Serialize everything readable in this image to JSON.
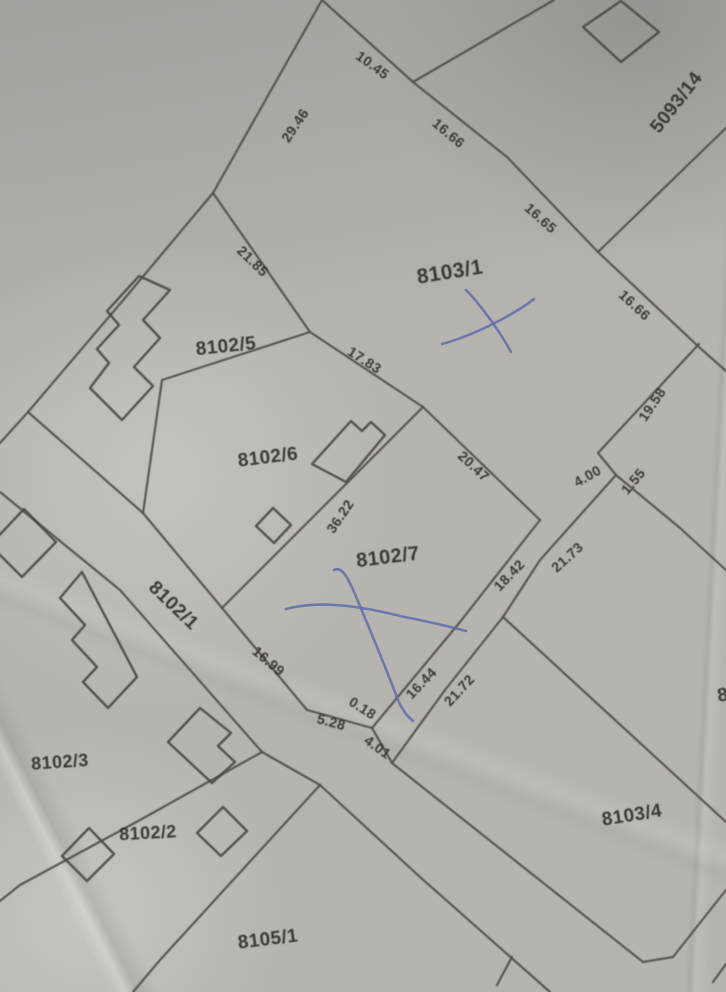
{
  "map": {
    "description": "cadastral-plan-photo",
    "colors": {
      "paper": "#b7b4b0",
      "boundary_line": "#514e49",
      "building_line": "#4c4944",
      "label_text": "#35322c",
      "pen_mark": "#5a6bac"
    },
    "parcels": [
      {
        "label": "5093/14",
        "x": 677,
        "y": 103,
        "rot": -52,
        "size": 19
      },
      {
        "label": "8103/1",
        "x": 450,
        "y": 273,
        "rot": -9,
        "size": 21
      },
      {
        "label": "8102/5",
        "x": 226,
        "y": 347,
        "rot": -6,
        "size": 19
      },
      {
        "label": "8102/6",
        "x": 268,
        "y": 458,
        "rot": -7,
        "size": 19
      },
      {
        "label": "8102/7",
        "x": 388,
        "y": 558,
        "rot": -7,
        "size": 20
      },
      {
        "label": "8102/1",
        "x": 173,
        "y": 606,
        "rot": 44,
        "size": 19
      },
      {
        "label": "8102/3",
        "x": 60,
        "y": 763,
        "rot": -4,
        "size": 18
      },
      {
        "label": "8102/2",
        "x": 148,
        "y": 834,
        "rot": -3,
        "size": 18
      },
      {
        "label": "8103/4",
        "x": 632,
        "y": 816,
        "rot": -9,
        "size": 19
      },
      {
        "label": "8105/1",
        "x": 268,
        "y": 940,
        "rot": -7,
        "size": 19
      },
      {
        "label": "8",
        "x": 723,
        "y": 696,
        "rot": -9,
        "size": 19
      }
    ],
    "measurements": [
      {
        "text": "10.45",
        "x": 372,
        "y": 66,
        "rot": 36
      },
      {
        "text": "16.66",
        "x": 448,
        "y": 134,
        "rot": 40
      },
      {
        "text": "29.46",
        "x": 296,
        "y": 126,
        "rot": -56
      },
      {
        "text": "16.65",
        "x": 540,
        "y": 219,
        "rot": 42
      },
      {
        "text": "16.66",
        "x": 634,
        "y": 306,
        "rot": 43
      },
      {
        "text": "21.85",
        "x": 252,
        "y": 262,
        "rot": 44
      },
      {
        "text": "17.83",
        "x": 364,
        "y": 361,
        "rot": 33
      },
      {
        "text": "20.47",
        "x": 473,
        "y": 467,
        "rot": 43
      },
      {
        "text": "19.58",
        "x": 653,
        "y": 405,
        "rot": -56
      },
      {
        "text": "4.00",
        "x": 588,
        "y": 477,
        "rot": -30
      },
      {
        "text": "1.55",
        "x": 634,
        "y": 482,
        "rot": -50
      },
      {
        "text": "21.73",
        "x": 568,
        "y": 558,
        "rot": -42
      },
      {
        "text": "18.42",
        "x": 510,
        "y": 576,
        "rot": -46
      },
      {
        "text": "36.22",
        "x": 341,
        "y": 517,
        "rot": -56
      },
      {
        "text": "16.44",
        "x": 422,
        "y": 684,
        "rot": -46
      },
      {
        "text": "21.72",
        "x": 460,
        "y": 691,
        "rot": -47
      },
      {
        "text": "16.99",
        "x": 268,
        "y": 662,
        "rot": 40
      },
      {
        "text": "0.18",
        "x": 362,
        "y": 709,
        "rot": 33
      },
      {
        "text": "5.28",
        "x": 331,
        "y": 723,
        "rot": 15
      },
      {
        "text": "4.01",
        "x": 377,
        "y": 748,
        "rot": 36
      }
    ],
    "boundaries": [
      {
        "name": "nw-block-edge",
        "points": [
          [
            322,
            0
          ],
          [
            213,
            193
          ],
          [
            125,
            298
          ],
          [
            28,
            412
          ],
          [
            0,
            443
          ]
        ]
      },
      {
        "name": "north-8103-1-edge",
        "points": [
          [
            322,
            0
          ],
          [
            413,
            82
          ],
          [
            507,
            157
          ],
          [
            598,
            252
          ],
          [
            700,
            348
          ],
          [
            726,
            371
          ]
        ]
      },
      {
        "name": "5093-14-west-edge",
        "points": [
          [
            413,
            82
          ],
          [
            554,
            0
          ]
        ]
      },
      {
        "name": "5093-14-south-edge",
        "points": [
          [
            598,
            252
          ],
          [
            726,
            128
          ]
        ]
      },
      {
        "name": "edge-21-85-17-83-20-47",
        "points": [
          [
            213,
            193
          ],
          [
            310,
            332
          ],
          [
            423,
            407
          ],
          [
            540,
            520
          ]
        ]
      },
      {
        "name": "edge-19-58",
        "points": [
          [
            699,
            344
          ],
          [
            598,
            453
          ],
          [
            616,
            475
          ]
        ]
      },
      {
        "name": "edge-1-55",
        "points": [
          [
            616,
            475
          ],
          [
            680,
            528
          ],
          [
            726,
            570
          ]
        ]
      },
      {
        "name": "edge-21-73-21-72",
        "points": [
          [
            616,
            475
          ],
          [
            540,
            560
          ],
          [
            503,
            617
          ],
          [
            445,
            690
          ],
          [
            392,
            763
          ]
        ]
      },
      {
        "name": "edge-18-42-16-44",
        "points": [
          [
            540,
            520
          ],
          [
            460,
            622
          ],
          [
            372,
            728
          ]
        ]
      },
      {
        "name": "edge-4-01",
        "points": [
          [
            372,
            728
          ],
          [
            392,
            763
          ]
        ]
      },
      {
        "name": "strip-ne-edge",
        "points": [
          [
            28,
            412
          ],
          [
            143,
            513
          ],
          [
            307,
            710
          ],
          [
            372,
            728
          ]
        ]
      },
      {
        "name": "edge-8102-5-6",
        "points": [
          [
            310,
            332
          ],
          [
            162,
            380
          ],
          [
            143,
            513
          ]
        ]
      },
      {
        "name": "edge-36-22",
        "points": [
          [
            423,
            407
          ],
          [
            222,
            608
          ]
        ]
      },
      {
        "name": "strip-sw-edge",
        "points": [
          [
            0,
            492
          ],
          [
            120,
            590
          ],
          [
            262,
            752
          ],
          [
            320,
            785
          ]
        ]
      },
      {
        "name": "edge-8102-2-3",
        "points": [
          [
            262,
            752
          ],
          [
            140,
            820
          ],
          [
            20,
            885
          ],
          [
            0,
            901
          ]
        ]
      },
      {
        "name": "edge-8105-1-west",
        "points": [
          [
            320,
            785
          ],
          [
            160,
            960
          ],
          [
            133,
            992
          ]
        ]
      },
      {
        "name": "edge-8105-1-east",
        "points": [
          [
            320,
            785
          ],
          [
            420,
            877
          ],
          [
            550,
            992
          ]
        ]
      },
      {
        "name": "edge-8103-4-nw",
        "points": [
          [
            503,
            617
          ],
          [
            726,
            822
          ]
        ]
      },
      {
        "name": "edge-8103-4-south",
        "points": [
          [
            392,
            763
          ],
          [
            643,
            962
          ],
          [
            673,
            957
          ],
          [
            726,
            890
          ]
        ]
      },
      {
        "name": "tick-bottom",
        "points": [
          [
            512,
            957
          ],
          [
            497,
            985
          ]
        ]
      },
      {
        "name": "corner-bottom-right",
        "points": [
          [
            713,
            982
          ],
          [
            726,
            964
          ]
        ]
      }
    ],
    "buildings": [
      {
        "name": "building-5093-14",
        "points": [
          [
            583,
            27
          ],
          [
            621,
            1
          ],
          [
            659,
            32
          ],
          [
            621,
            62
          ]
        ]
      },
      {
        "name": "building-8102-5-stepped",
        "points": [
          [
            170,
            290
          ],
          [
            143,
            320
          ],
          [
            160,
            338
          ],
          [
            134,
            367
          ],
          [
            153,
            386
          ],
          [
            122,
            420
          ],
          [
            90,
            388
          ],
          [
            109,
            363
          ],
          [
            97,
            349
          ],
          [
            119,
            325
          ],
          [
            107,
            311
          ],
          [
            139,
            276
          ]
        ]
      },
      {
        "name": "building-8102-6-main",
        "points": [
          [
            312,
            464
          ],
          [
            351,
            421
          ],
          [
            362,
            431
          ],
          [
            371,
            422
          ],
          [
            385,
            435
          ],
          [
            346,
            482
          ]
        ]
      },
      {
        "name": "building-8102-6-shed",
        "points": [
          [
            256,
            526
          ],
          [
            273,
            508
          ],
          [
            291,
            525
          ],
          [
            274,
            543
          ]
        ]
      },
      {
        "name": "building-strip-stepped",
        "points": [
          [
            82,
            572
          ],
          [
            60,
            598
          ],
          [
            85,
            625
          ],
          [
            72,
            640
          ],
          [
            97,
            667
          ],
          [
            83,
            682
          ],
          [
            108,
            708
          ],
          [
            137,
            677
          ]
        ]
      },
      {
        "name": "building-left-edge",
        "points": [
          [
            -10,
            545
          ],
          [
            24,
            509
          ],
          [
            56,
            542
          ],
          [
            22,
            577
          ]
        ]
      },
      {
        "name": "building-8102-3-notched",
        "points": [
          [
            200,
            708
          ],
          [
            168,
            742
          ],
          [
            212,
            783
          ],
          [
            235,
            762
          ],
          [
            218,
            746
          ],
          [
            231,
            733
          ]
        ]
      },
      {
        "name": "building-8102-3-square",
        "points": [
          [
            62,
            856
          ],
          [
            89,
            828
          ],
          [
            114,
            854
          ],
          [
            87,
            881
          ]
        ]
      },
      {
        "name": "building-8102-2-square",
        "points": [
          [
            197,
            833
          ],
          [
            223,
            807
          ],
          [
            247,
            831
          ],
          [
            221,
            856
          ]
        ]
      }
    ],
    "pen_marks": [
      {
        "name": "pen-x-8103-1-stroke-a",
        "path": "M 466,290 C 478,302 498,328 511,352"
      },
      {
        "name": "pen-x-8103-1-stroke-b",
        "path": "M 534,299 C 512,316 472,336 442,344"
      },
      {
        "name": "pen-x-8102-7-stroke-a",
        "path": "M 334,570 C 342,566 348,578 355,594 C 370,630 386,668 398,700 C 402,710 407,716 413,721"
      },
      {
        "name": "pen-x-8102-7-stroke-b",
        "path": "M 286,609 C 320,600 360,606 400,616 C 425,621 448,626 466,631"
      }
    ]
  }
}
